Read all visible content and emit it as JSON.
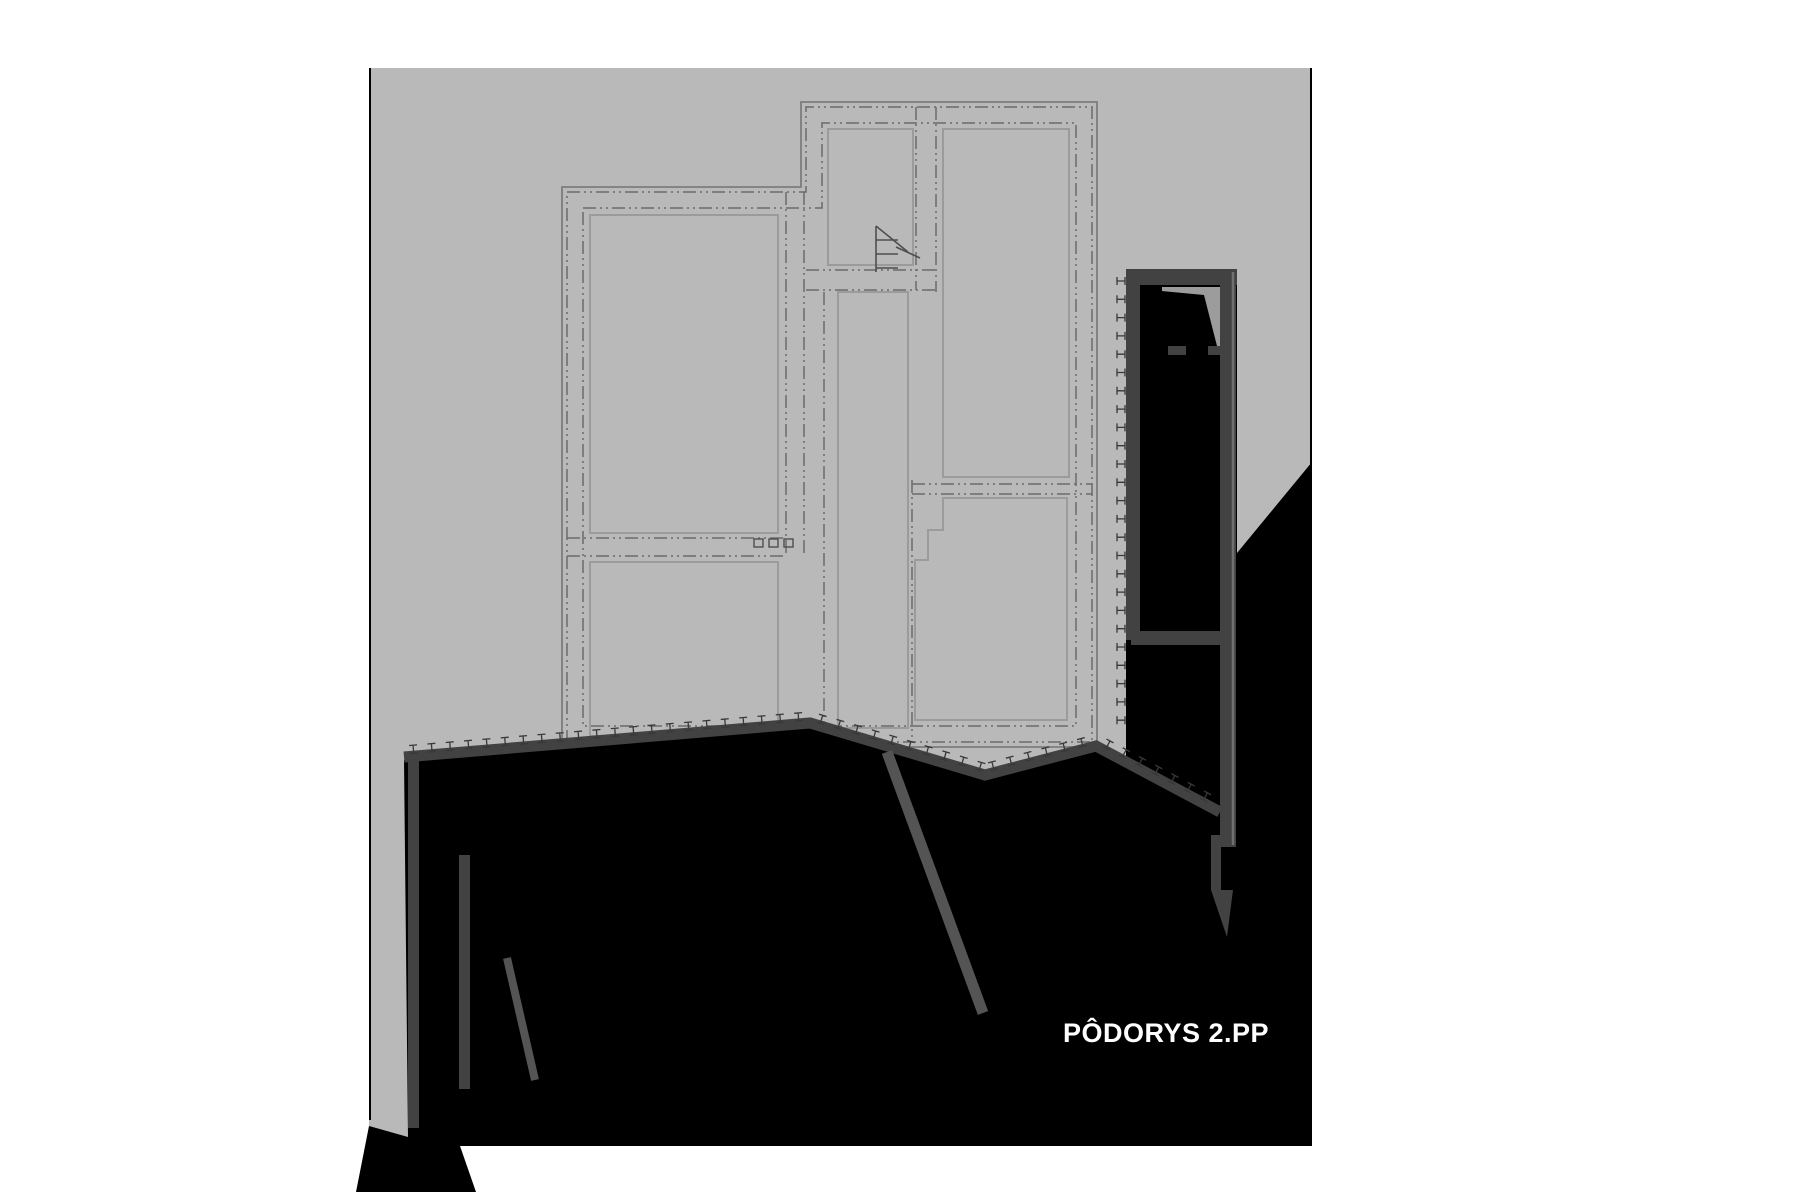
{
  "title": {
    "text": "PÔDORYS 2.PP",
    "color": "#ffffff",
    "size": 27
  },
  "drawing": {
    "page_color": "#ffffff",
    "area": {
      "x": 369,
      "y": 68,
      "w": 943,
      "h": 1078,
      "fill": "#b9b9b9"
    },
    "edge_color": "#000000",
    "edges": [
      {
        "x1": 370,
        "y1": 68,
        "x2": 370,
        "y2": 1120
      },
      {
        "x1": 1311,
        "y1": 68,
        "x2": 1311,
        "y2": 470
      }
    ]
  },
  "terrain": {
    "color": "#000000",
    "main": [
      [
        404,
        760
      ],
      [
        812,
        726
      ],
      [
        985,
        779
      ],
      [
        1096,
        749
      ],
      [
        1222,
        817
      ],
      [
        1222,
        553
      ],
      [
        1237,
        553
      ],
      [
        1312,
        462
      ],
      [
        1312,
        1146
      ],
      [
        460,
        1146
      ],
      [
        476,
        1192
      ],
      [
        356,
        1192
      ],
      [
        369,
        1126
      ],
      [
        408,
        1137
      ]
    ],
    "between_walls": [
      [
        1126,
        284
      ],
      [
        1237,
        284
      ],
      [
        1237,
        820
      ],
      [
        1126,
        820
      ]
    ]
  },
  "walls": {
    "color": "#424242",
    "band": {
      "points": [
        [
          404,
          757
        ],
        [
          810,
          723
        ],
        [
          985,
          775
        ],
        [
          1096,
          746
        ],
        [
          1220,
          812
        ]
      ],
      "width": 11
    },
    "bars": [
      {
        "x": 408,
        "y": 757,
        "w": 11,
        "h": 371
      },
      {
        "x": 459,
        "y": 855,
        "w": 11,
        "h": 234
      }
    ],
    "diagonals": [
      {
        "x1": 887,
        "y1": 752,
        "x2": 983,
        "y2": 1013,
        "w": 11
      },
      {
        "x1": 507,
        "y1": 958,
        "x2": 535,
        "y2": 1080,
        "w": 8
      }
    ],
    "right_assembly": {
      "top_bar": {
        "x": 1126,
        "y": 269,
        "w": 111,
        "h": 16
      },
      "inner_wall": {
        "x": 1126,
        "y": 284,
        "w": 14,
        "h": 356
      },
      "stub": {
        "x": 1131,
        "y": 631,
        "w": 91,
        "h": 14
      },
      "outer_wall": {
        "x": 1220,
        "y": 269,
        "w": 16,
        "h": 578
      },
      "edge_line": {
        "x": 1233,
        "y1": 272,
        "y2": 845,
        "color": "#707070",
        "w": 2.5
      },
      "lower_strip": {
        "x": 1211,
        "y": 835,
        "w": 10,
        "h": 55
      },
      "wedge": [
        [
          1211,
          890
        ],
        [
          1233,
          890
        ],
        [
          1227,
          937
        ]
      ],
      "pocket": {
        "x": 1162,
        "y": 287,
        "w": 62,
        "h": 59,
        "fill": "#9c9c9c"
      },
      "pocket_black": [
        [
          1140,
          289
        ],
        [
          1204,
          295
        ],
        [
          1217,
          346
        ],
        [
          1140,
          346
        ]
      ],
      "stubs": [
        {
          "x": 1168,
          "y": 346,
          "w": 18,
          "h": 9
        },
        {
          "x": 1208,
          "y": 346,
          "w": 15,
          "h": 9
        }
      ]
    }
  },
  "hatch": {
    "color": "#383838",
    "lw": 1.3,
    "step": 18.4,
    "offset": 7,
    "vertical": {
      "x": 1121,
      "y0": 281,
      "y1": 722,
      "step": 18.3
    }
  },
  "plan": {
    "outline": [
      [
        562,
        187
      ],
      [
        801,
        187
      ],
      [
        801,
        102
      ],
      [
        1097,
        102
      ],
      [
        1097,
        747
      ],
      [
        562,
        747
      ]
    ],
    "outline_color": "#7d7d7d",
    "ring1": [
      [
        567,
        192
      ],
      [
        806,
        192
      ],
      [
        806,
        107
      ],
      [
        1092,
        107
      ],
      [
        1092,
        742
      ],
      [
        567,
        742
      ]
    ],
    "ring2": [
      [
        583,
        208
      ],
      [
        822,
        208
      ],
      [
        822,
        123
      ],
      [
        1076,
        123
      ],
      [
        1076,
        726
      ],
      [
        583,
        726
      ]
    ],
    "dash_color": "#6a6a6a",
    "dash": "13 4 2 4 2 4",
    "room_color": "#9b9b9b",
    "rooms": [
      {
        "type": "rect",
        "x": 828,
        "y": 129,
        "w": 85,
        "h": 136
      },
      {
        "type": "rect",
        "x": 943,
        "y": 129,
        "w": 126,
        "h": 348
      },
      {
        "type": "rect",
        "x": 590,
        "y": 215,
        "w": 188,
        "h": 318
      },
      {
        "type": "rect",
        "x": 838,
        "y": 292,
        "w": 70,
        "h": 436
      },
      {
        "type": "path",
        "d": "M 943,498 L 1067,498 L 1067,720 L 915,720 L 915,560 L 928,560 L 928,530 L 943,530 Z"
      },
      {
        "type": "rect",
        "x": 590,
        "y": 562,
        "w": 188,
        "h": 174
      }
    ],
    "partitions": [
      {
        "x1": 786,
        "y1": 192,
        "x2": 786,
        "y2": 556
      },
      {
        "x1": 804,
        "y1": 192,
        "x2": 804,
        "y2": 556
      },
      {
        "x1": 824,
        "y1": 292,
        "x2": 824,
        "y2": 742
      },
      {
        "x1": 916,
        "y1": 107,
        "x2": 916,
        "y2": 290
      },
      {
        "x1": 936,
        "y1": 107,
        "x2": 936,
        "y2": 292
      },
      {
        "x1": 912,
        "y1": 480,
        "x2": 912,
        "y2": 742
      },
      {
        "x1": 806,
        "y1": 270,
        "x2": 936,
        "y2": 270
      },
      {
        "x1": 806,
        "y1": 290,
        "x2": 936,
        "y2": 290
      },
      {
        "x1": 912,
        "y1": 484,
        "x2": 1092,
        "y2": 484
      },
      {
        "x1": 912,
        "y1": 494,
        "x2": 1092,
        "y2": 494
      },
      {
        "x1": 567,
        "y1": 538,
        "x2": 786,
        "y2": 538
      },
      {
        "x1": 567,
        "y1": 556,
        "x2": 786,
        "y2": 556
      }
    ],
    "stair": {
      "color": "#4f4f4f",
      "lines": [
        "M 876,226 L 876,272",
        "M 876,240 L 898,240",
        "M 876,254 L 898,254",
        "M 876,268 L 898,268",
        "M 876,226 L 908,252",
        "M 896,247 L 920,258"
      ]
    },
    "squares": [
      {
        "x": 754,
        "y": 539,
        "w": 9,
        "h": 8
      },
      {
        "x": 769,
        "y": 539,
        "w": 9,
        "h": 8
      },
      {
        "x": 784,
        "y": 539,
        "w": 9,
        "h": 8
      }
    ]
  }
}
